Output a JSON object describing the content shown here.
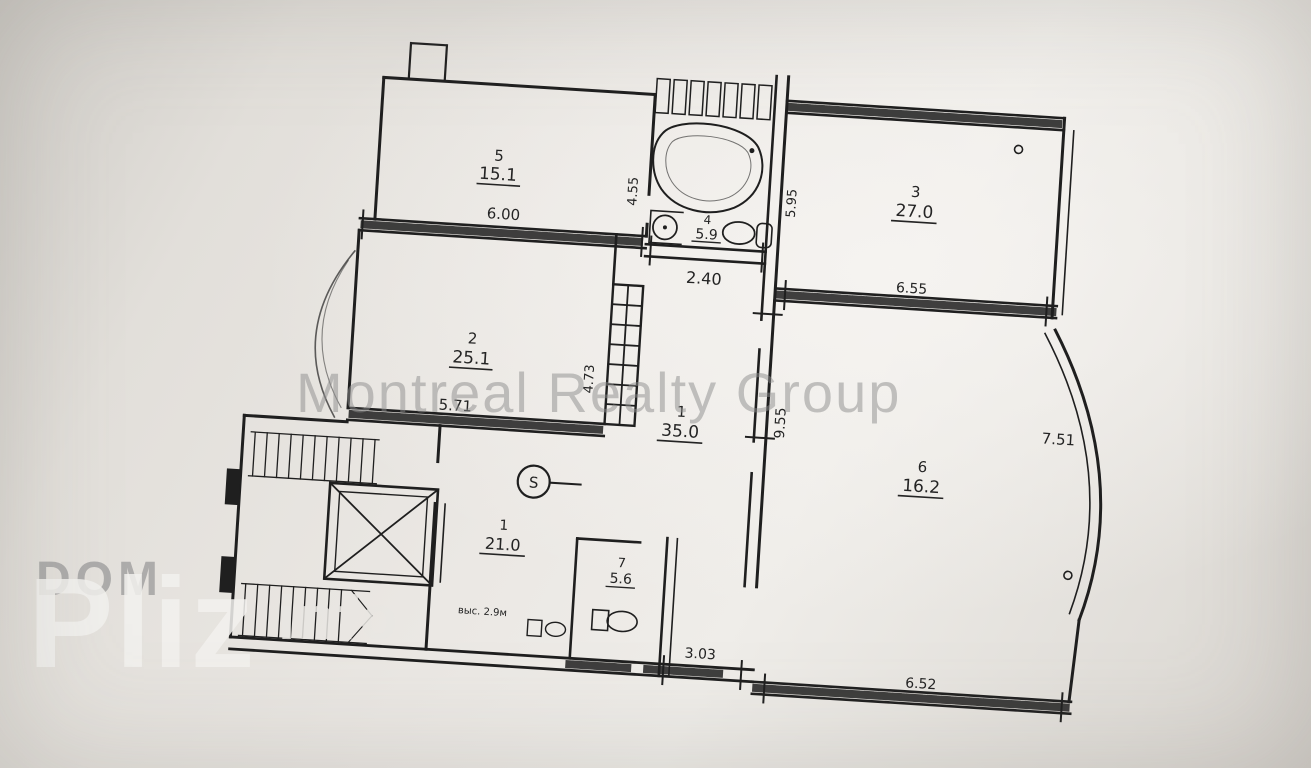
{
  "document": {
    "type": "scanned apartment floor plan"
  },
  "watermarks": {
    "center": "Montreal Realty Group",
    "dom": "DOM",
    "pliz": "Pliz",
    "info": "info"
  },
  "rooms": {
    "top_left": {
      "number": "5",
      "area": "15.1"
    },
    "room2": {
      "number": "2",
      "area": "25.1"
    },
    "room3": {
      "number": "3",
      "area": "27.0"
    },
    "bathroom": {
      "number": "4",
      "area": "5.9"
    },
    "hall": {
      "number": "1",
      "area": "35.0"
    },
    "room6": {
      "number": "6",
      "area": "16.2"
    },
    "kitchen": {
      "number": "1",
      "area": "21.0"
    },
    "wc": {
      "number": "7",
      "area": "5.6"
    }
  },
  "dimensions": {
    "top_left_width": "6.00",
    "bath_left": "4.55",
    "bath_width": "2.40",
    "bath_right": "5.95",
    "room3_width": "6.55",
    "room2_width": "5.71",
    "room2_right": "4.73",
    "hall_right": "9.55",
    "bay": "7.51",
    "bottom_small": "3.03",
    "room6_width": "6.52"
  },
  "marker": {
    "label": "S"
  },
  "annotation": {
    "text": "выс. 2.9м"
  },
  "colors": {
    "ink": "#1f1f1f",
    "paper": "#ebe8e4",
    "watermark_gray": "#8d8d8d",
    "watermark_light": "#f3f2ef"
  }
}
